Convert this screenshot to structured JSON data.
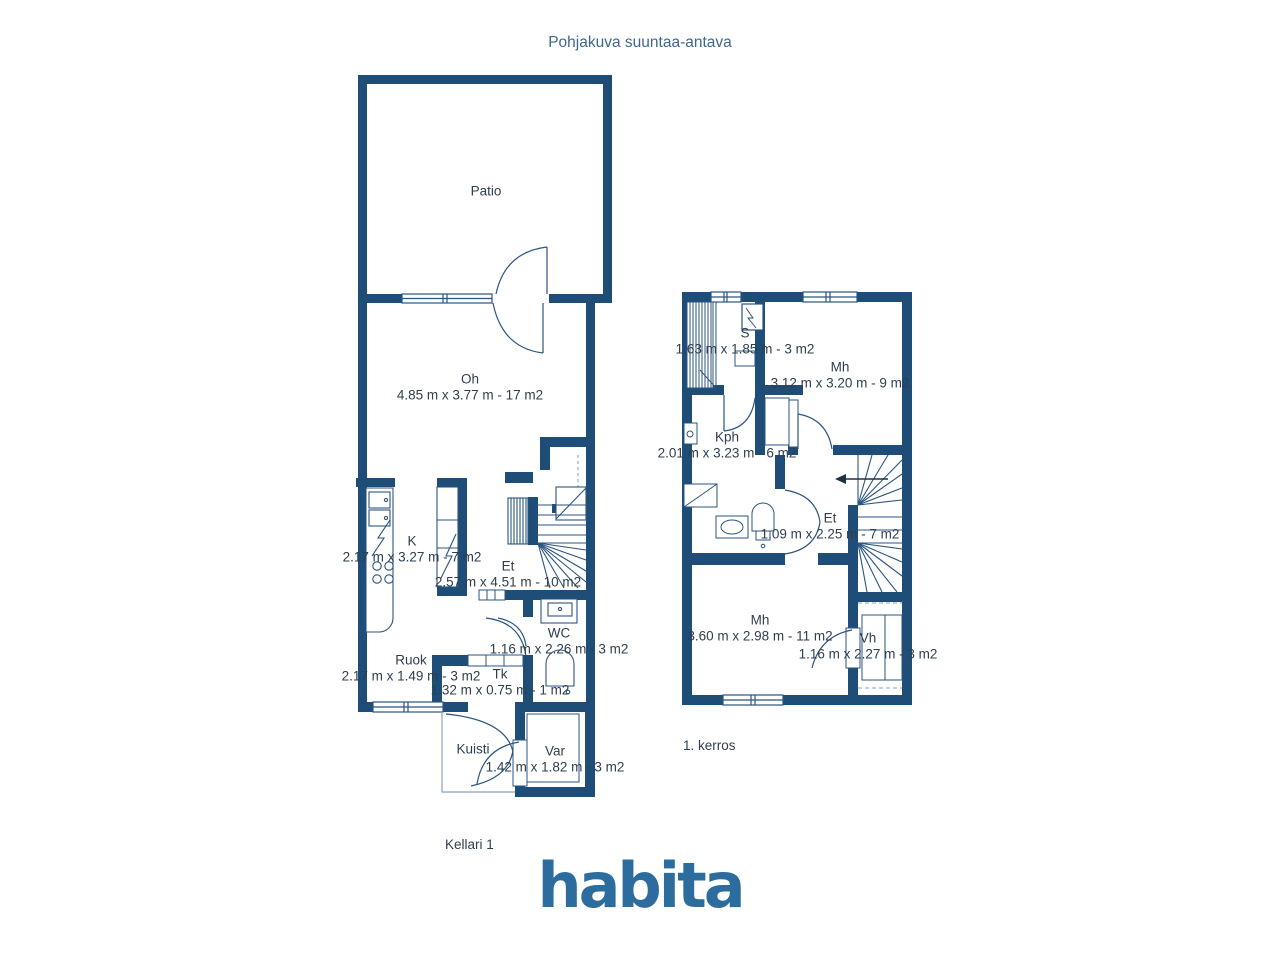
{
  "title": "Pohjakuva suuntaa-antava",
  "logo_text": "habita",
  "colors": {
    "wall": "#1e4d78",
    "thin_line": "#2b5580",
    "dashed_line": "#8aa5bd",
    "room_text": "#2f3e4e",
    "title_text": "#3e688d",
    "logo": "#2d6d9d"
  },
  "floors": {
    "kellari": {
      "caption": "Kellari 1",
      "rooms": {
        "patio": {
          "name": "Patio",
          "dims": ""
        },
        "oh": {
          "name": "Oh",
          "dims": "4.85 m x 3.77 m - 17 m2"
        },
        "k": {
          "name": "K",
          "dims": "2.17 m x 3.27 m - 7 m2"
        },
        "et": {
          "name": "Et",
          "dims": "2.57 m x 4.51 m - 10 m2"
        },
        "wc": {
          "name": "WC",
          "dims": "1.16 m x 2.26 m - 3 m2"
        },
        "ruok": {
          "name": "Ruok",
          "dims": "2.17 m x 1.49 m - 3 m2"
        },
        "tk": {
          "name": "Tk",
          "dims": "1.32 m x 0.75 m - 1 m2"
        },
        "kuisti": {
          "name": "Kuisti",
          "dims": ""
        },
        "var": {
          "name": "Var",
          "dims": "1.42 m x 1.82 m - 3 m2"
        }
      }
    },
    "kerros1": {
      "caption": "1. kerros",
      "rooms": {
        "s": {
          "name": "S",
          "dims": "1.63 m x 1.85 m - 3 m2"
        },
        "mh1": {
          "name": "Mh",
          "dims": "3.12 m x 3.20 m - 9 m2"
        },
        "kph": {
          "name": "Kph",
          "dims": "2.01 m x 3.23 m - 6 m2"
        },
        "et": {
          "name": "Et",
          "dims": "1.09 m x 2.25 m - 7 m2"
        },
        "mh2": {
          "name": "Mh",
          "dims": "3.60 m x 2.98 m - 11 m2"
        },
        "vh": {
          "name": "Vh",
          "dims": "1.16 m x 2.27 m - 3 m2"
        }
      }
    }
  }
}
